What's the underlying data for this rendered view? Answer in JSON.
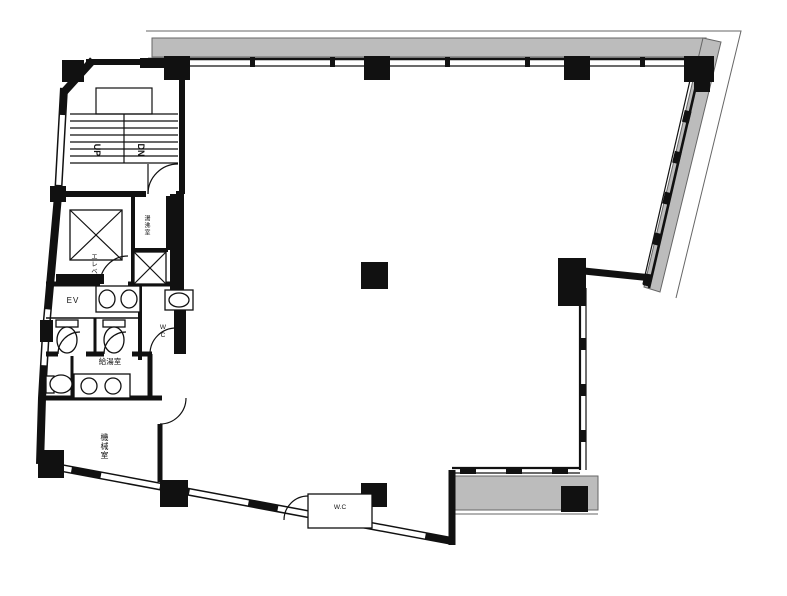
{
  "floorplan": {
    "labels": {
      "up": "UP",
      "down": "DN",
      "elevator": "エレベ",
      "water_heater_room": "湯沸室",
      "elevator_hall": "EV",
      "toilet": "WC",
      "kitchenette": "給湯室",
      "machine_room": "機械室",
      "wall_box": "W.C"
    },
    "colors": {
      "wall": "#111111",
      "balcony_fill": "#bcbcbc",
      "outline": "#666666",
      "background": "#ffffff"
    }
  }
}
